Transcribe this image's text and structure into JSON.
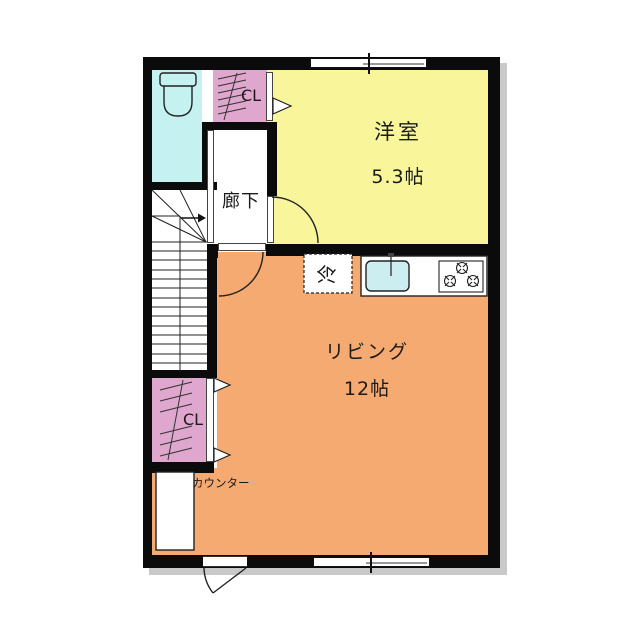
{
  "floorplan": {
    "rooms": {
      "western_room": {
        "name": "洋室",
        "size": "5.3帖"
      },
      "living": {
        "name": "リビング",
        "size": "12帖"
      },
      "hallway": {
        "name": "廊下"
      },
      "closet_top": {
        "label": "CL"
      },
      "closet_bottom": {
        "label": "CL"
      },
      "counter": {
        "label": "カウンター"
      },
      "fridge": {
        "label": "冷"
      }
    },
    "colors": {
      "western_room": "#f8f59b",
      "living": "#f5aa71",
      "closet": "#dfa7cd",
      "toilet": "#c5f1f1",
      "sink": "#cdeef0",
      "wall": "#0b0b0b",
      "shadow": "#c9c9c9",
      "line": "#222222"
    }
  }
}
